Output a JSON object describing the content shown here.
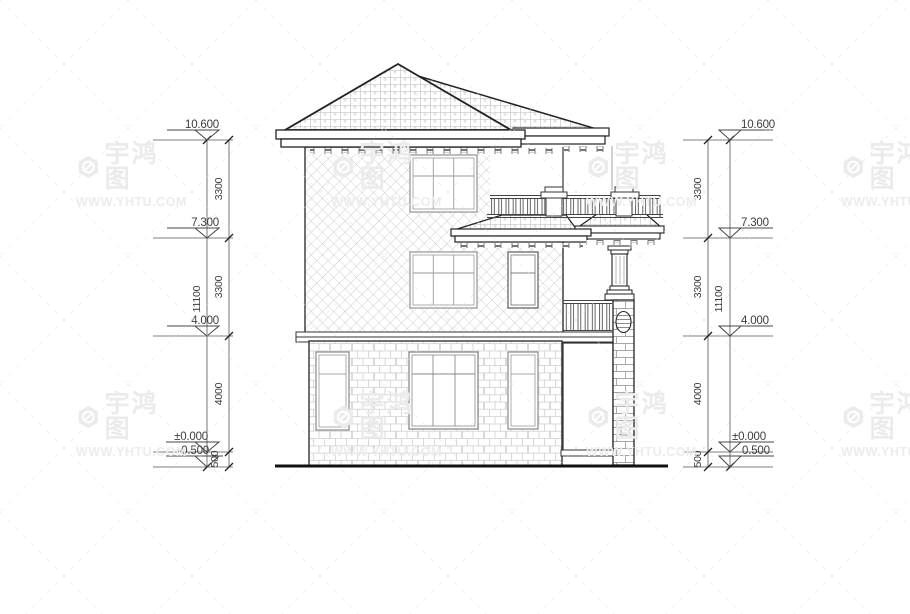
{
  "watermark": {
    "brand": "宇鸿图",
    "site": "WWW.YHTU.COM"
  },
  "dimensions": {
    "left": {
      "levels": [
        "10.600",
        "7.300",
        "4.000",
        "±0.000",
        "-0.500"
      ],
      "segments": [
        "3300",
        "3300",
        "4000",
        "500"
      ],
      "overall": "11100"
    },
    "right": {
      "levels": [
        "10.600",
        "7.300",
        "4.000",
        "±0.000",
        "0.500"
      ],
      "segments": [
        "3300",
        "3300",
        "4000",
        "500"
      ],
      "overall": "11100"
    }
  }
}
